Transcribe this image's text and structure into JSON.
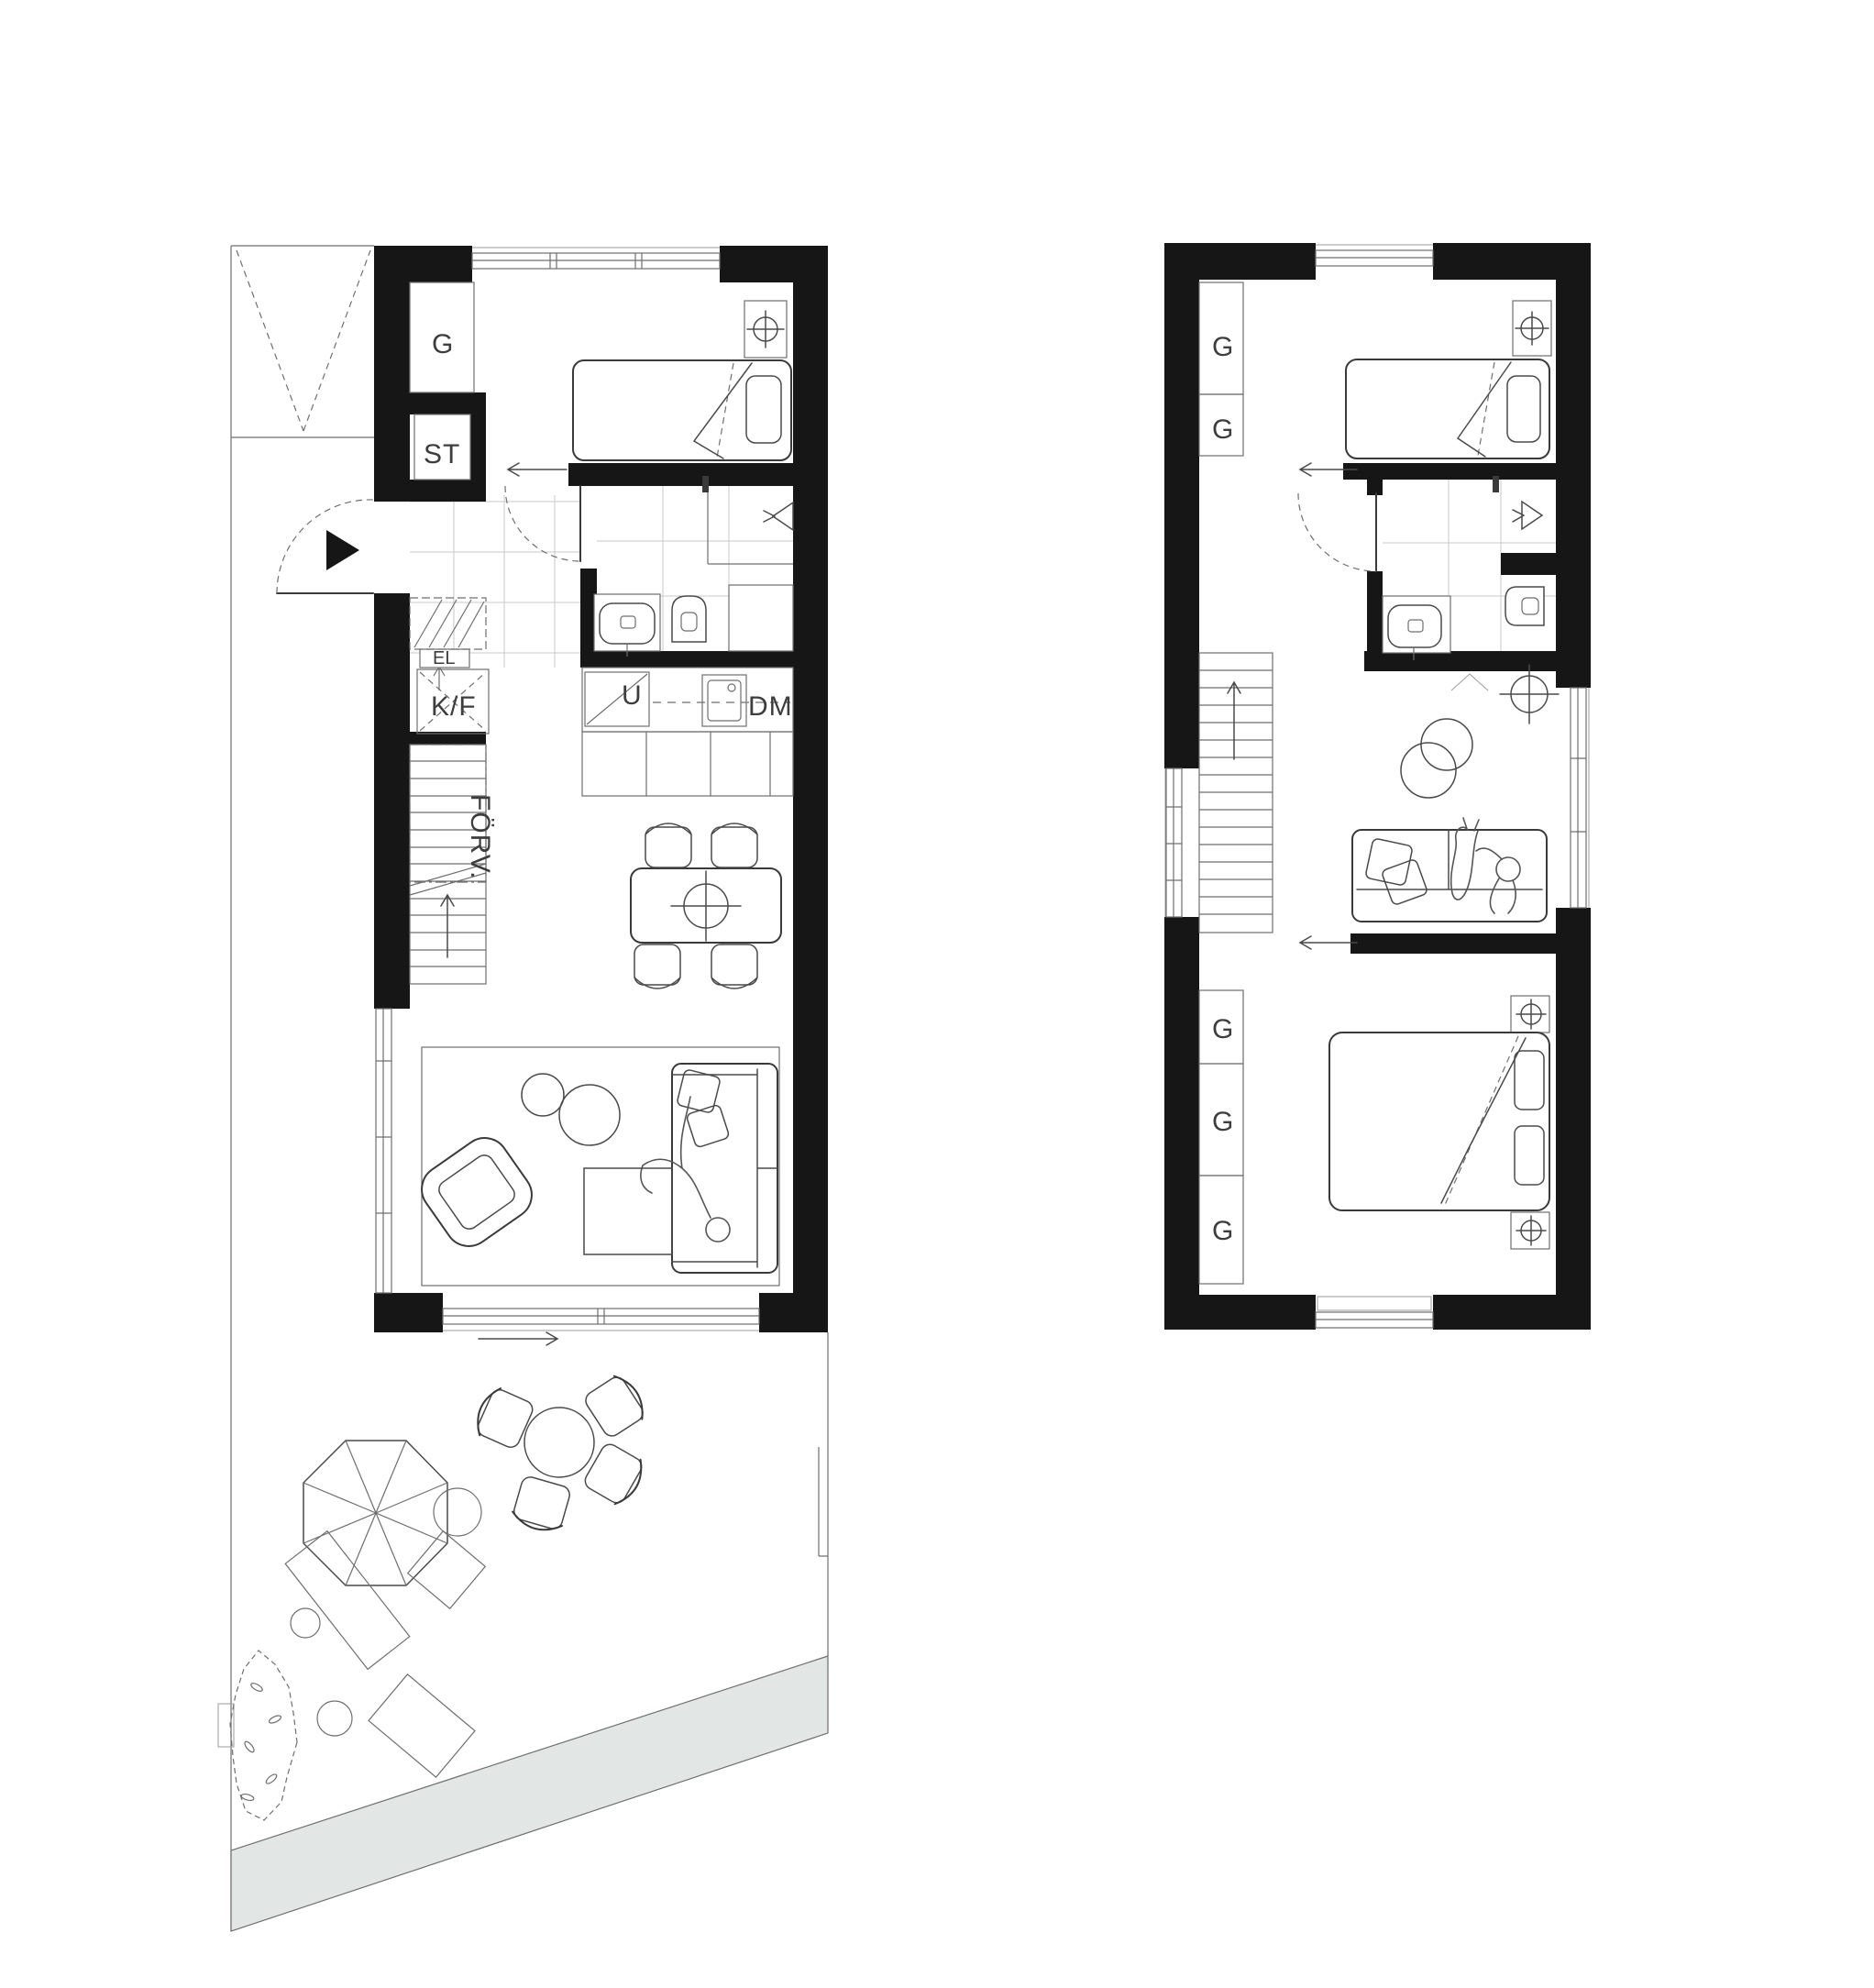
{
  "document": {
    "type": "architectural-floor-plan",
    "background": "#ffffff",
    "plans": [
      {
        "id": "ground-floor",
        "features": [
          "entrance",
          "wardrobe",
          "cleaning-closet",
          "bathroom",
          "kitchen",
          "dining",
          "living-room",
          "stairs",
          "garden-terrace"
        ]
      },
      {
        "id": "upper-floor",
        "features": [
          "bedroom",
          "bathroom",
          "tv-lounge",
          "stairs",
          "master-bedroom",
          "wardrobes"
        ]
      }
    ]
  },
  "colors": {
    "wall": "#161616",
    "line": "#3a3a3a",
    "thin_line": "#9b9b9b",
    "tile_line": "#c9c9c9",
    "walkway_fill": "#e2e7e5",
    "label_text": "#3d3d3d"
  },
  "room_labels": {
    "wardrobe": "G",
    "cleaning_closet": "ST",
    "electrical_cabinet": "EL",
    "fridge_freezer": "K/F",
    "under_stair_storage": "FÖRV.",
    "oven": "U",
    "dishwasher": "DM"
  },
  "icons": {
    "ceiling_light_icon": "circle-with-crosshair",
    "floor_drain_icon": "hollow-triangle-with-chevrons",
    "entrance_icon": "solid-black-triangle",
    "stair_direction_icon": "arrow-up",
    "passage_icon": "arrow-left",
    "sliding_door_icon": "arrow-right"
  }
}
